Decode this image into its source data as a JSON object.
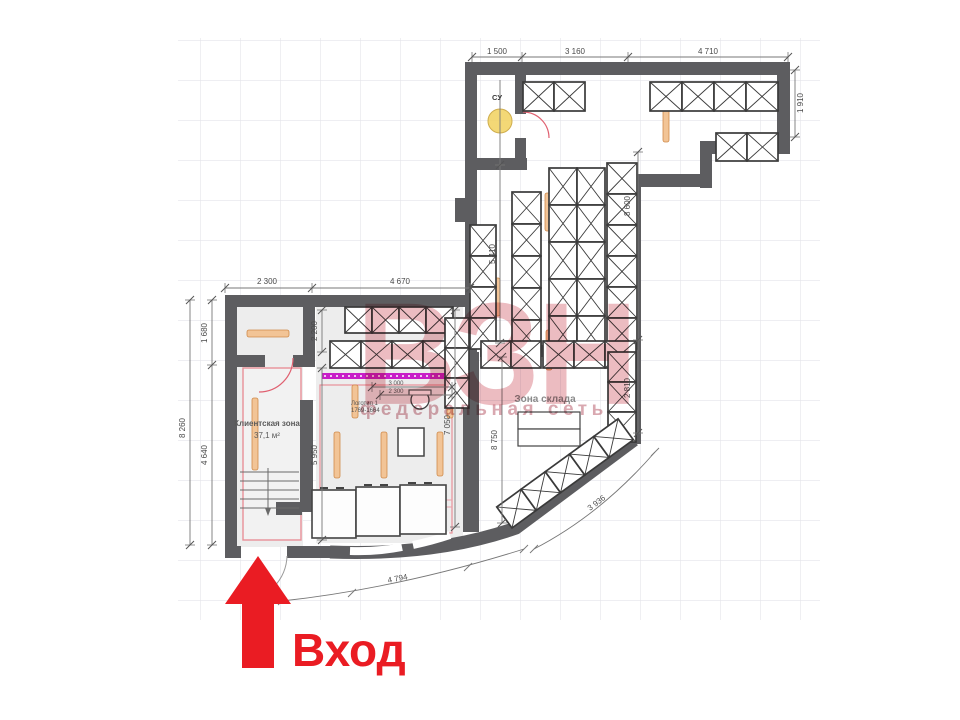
{
  "watermark": {
    "logo": "ВЗН",
    "subtitle": "федеральная сеть"
  },
  "entrance": {
    "label": "Вход"
  },
  "rooms": {
    "client": {
      "name": "Клиентская зона",
      "area": "37,1 м²"
    },
    "storage": {
      "name": "Зона склада"
    },
    "su": {
      "name": "СУ"
    }
  },
  "annotations": {
    "logo_item": "Логотип 1",
    "logo_code": "1769-1664"
  },
  "dimensions": {
    "top1": "1 500",
    "top2": "3 160",
    "top3": "4 710",
    "right_top": "1 910",
    "right_upper": "8 600",
    "right_lower": "2 810",
    "storage_left": "5 410",
    "storage_inner": "8 750",
    "mid_left": "7 050",
    "sales_left": "5 950",
    "left_room": "2 200",
    "left_outer": "8 260",
    "left_seg_top": "1 680",
    "left_seg_bottom": "4 640",
    "lower_top1": "2 300",
    "lower_top2": "4 670",
    "logo_w1": "3 000",
    "logo_w2": "2 300",
    "diag": "3 936",
    "arc": "4 794"
  },
  "colors": {
    "wall": "#5d5d60",
    "accent_red": "#ea1c23",
    "watermark_pink": "#cf5664",
    "magenta": "#c81ec8",
    "shelf_orange": "#f2c496",
    "grid": "#e4e4ea"
  }
}
